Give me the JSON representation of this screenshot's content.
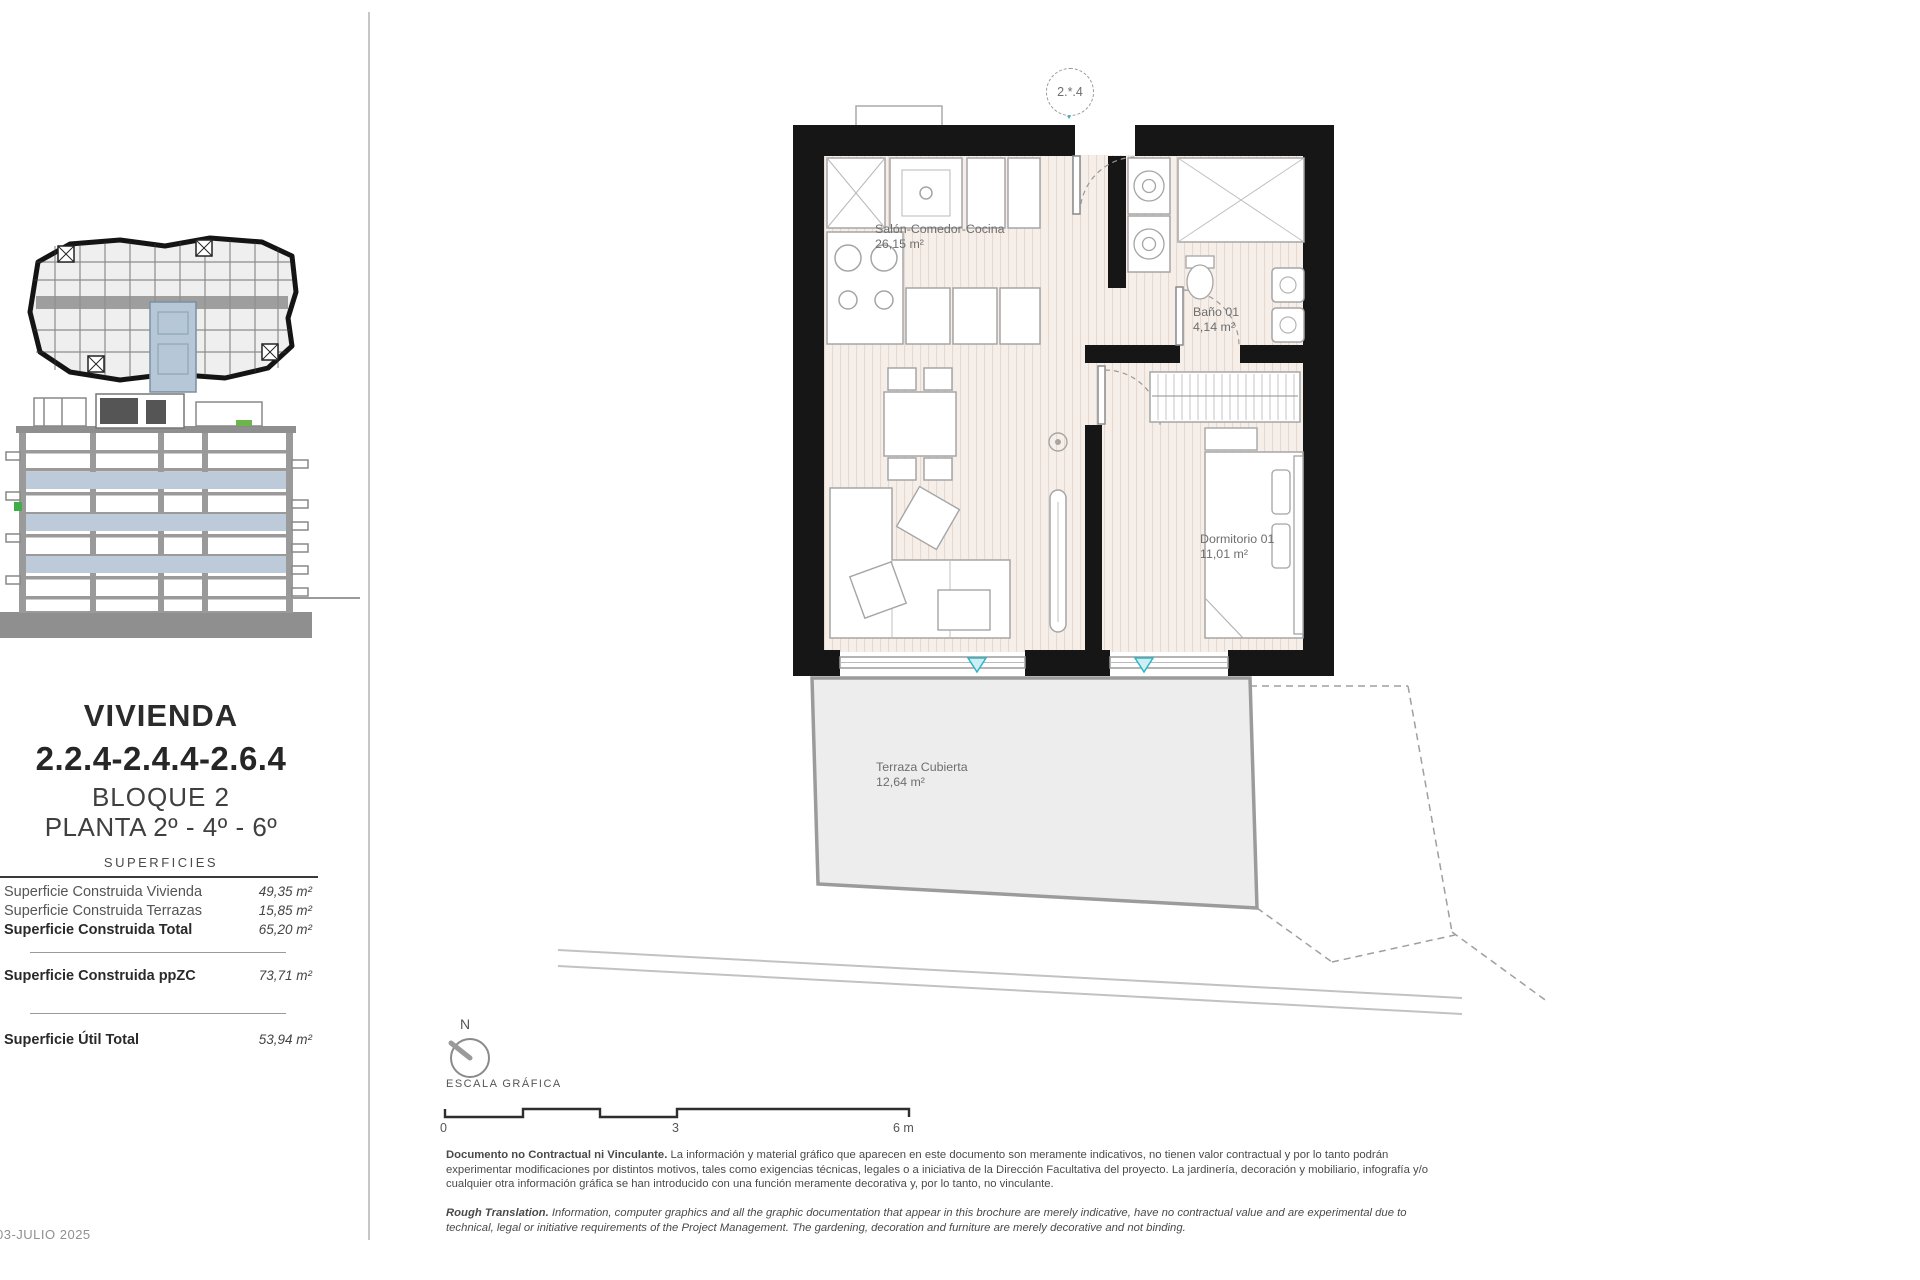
{
  "sidebar": {
    "title_line1": "VIVIENDA",
    "title_line2": "2.2.4-2.4.4-2.6.4",
    "subtitle_block": "BLOQUE 2",
    "subtitle_floor": "PLANTA 2º - 4º - 6º",
    "table_header": "SUPERFICIES",
    "rows": [
      {
        "label": "Superficie Construida Vivienda",
        "value": "49,35 m²"
      },
      {
        "label": "Superficie Construida Terrazas",
        "value": "15,85 m²"
      },
      {
        "label": "Superficie Construida Total",
        "value": "65,20 m²"
      },
      {
        "label": "Superficie Construida ppZC",
        "value": "73,71 m²"
      },
      {
        "label": "Superficie Útil Total",
        "value": "53,94 m²"
      }
    ],
    "date": "03-JULIO 2025"
  },
  "plan": {
    "unit_badge": "2.*.4",
    "rooms": [
      {
        "name": "Salón-Comedor-Cocina",
        "area": "26,15 m²"
      },
      {
        "name": "Baño 01",
        "area": "4,14 m²"
      },
      {
        "name": "Dormitorio 01",
        "area": "11,01 m²"
      },
      {
        "name": "Terraza Cubierta",
        "area": "12,64 m²"
      }
    ]
  },
  "scale": {
    "north_label": "N",
    "title": "ESCALA GRÁFICA",
    "tick_0": "0",
    "tick_3": "3",
    "tick_6": "6 m"
  },
  "disclaimer": {
    "es_lead": "Documento no Contractual ni Vinculante.",
    "es_body": " La información y material gráfico que aparecen en este documento son meramente indicativos, no tienen valor contractual y por lo tanto podrán experimentar modificaciones por distintos motivos, tales como exigencias técnicas, legales o a iniciativa de la Dirección Facultativa del proyecto. La jardinería, decoración y mobiliario, infografía y/o cualquier otra información gráfica se han introducido con una función meramente decorativa y, por lo tanto, no vinculante.",
    "en_lead": "Rough Translation.",
    "en_body": " Information, computer graphics and all the graphic documentation that appear in this brochure are merely indicative, have no contractual value and are experimental due to technical, legal or initiative requirements of the Project Management. The gardening, decoration and furniture are merely decorative and not binding."
  },
  "colors": {
    "wall": "#161616",
    "floor": "#f6efe9",
    "terrace": "#ededed",
    "highlight_blue": "#b6c8d8",
    "accent_teal": "#2fb4c4",
    "accent_green": "#3fae49"
  }
}
